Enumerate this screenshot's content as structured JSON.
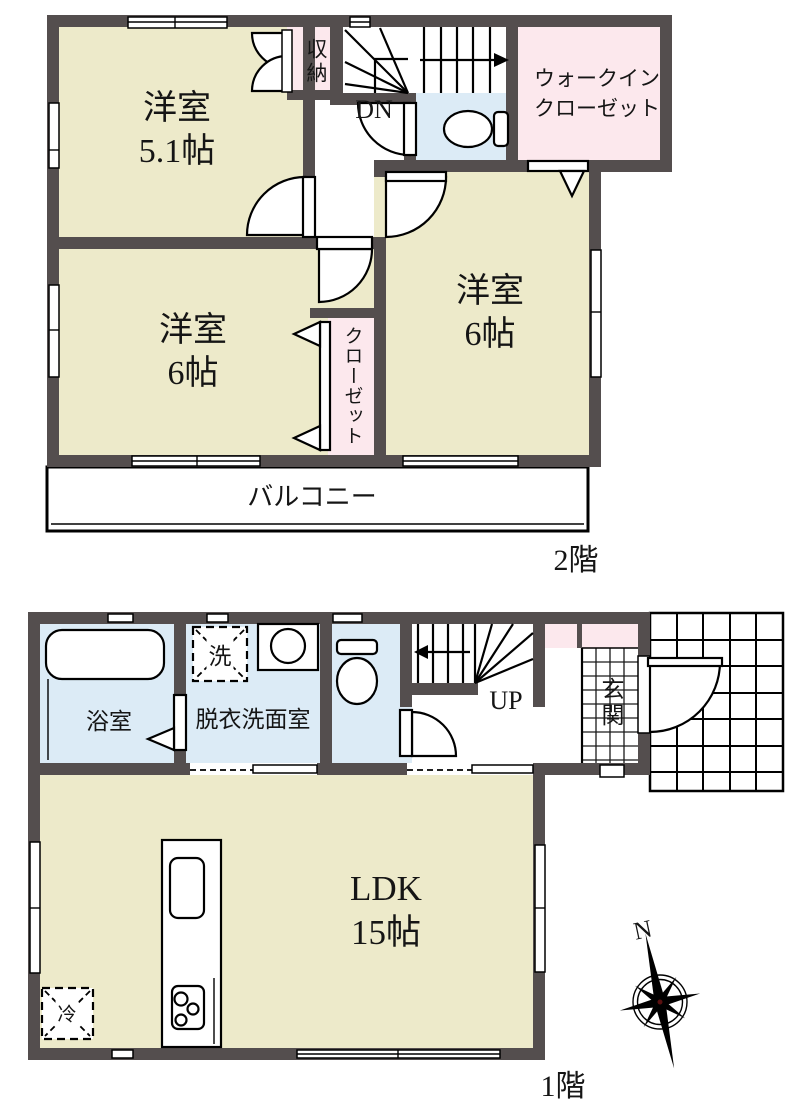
{
  "title": "住宅間取り図",
  "colors": {
    "wall": "#544e4e",
    "room_cream": "#edeaca",
    "wet_blue": "#dcebf6",
    "closet_pink": "#fce8ed",
    "line_black": "#000000"
  },
  "floor2": {
    "floor_label": "2階",
    "room_5_1": {
      "name": "洋室",
      "size": "5.1帖"
    },
    "room_6_left": {
      "name": "洋室",
      "size": "6帖"
    },
    "room_6_right": {
      "name": "洋室",
      "size": "6帖"
    },
    "storage_label": "収納",
    "wic_line1": "ウォークイン",
    "wic_line2": "クローゼット",
    "closet_label": "クローゼット",
    "balcony_label": "バルコニー",
    "stairs_label": "DN"
  },
  "floor1": {
    "floor_label": "1階",
    "ldk": {
      "name": "LDK",
      "size": "15帖"
    },
    "bath_label": "浴室",
    "washroom_label": "脱衣洗面室",
    "entrance_label": "玄関",
    "stairs_label": "UP",
    "washer_label": "洗",
    "fridge_label": "冷",
    "compass_north_label": "N"
  }
}
